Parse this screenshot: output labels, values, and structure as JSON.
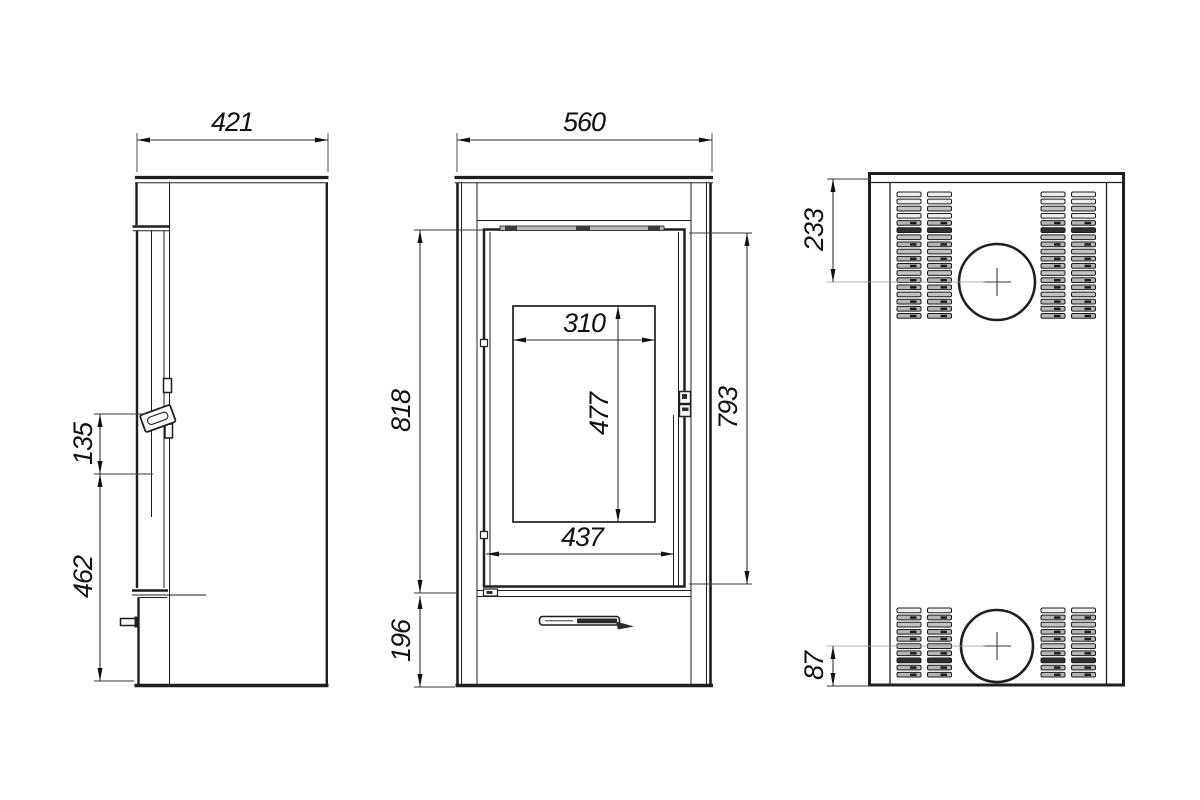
{
  "drawing": {
    "type": "technical-three-view-drawing",
    "subject": "freestanding stove",
    "background": "#ffffff",
    "line_color": "#1f1f1f",
    "dim_text_color": "#111111",
    "views": [
      {
        "id": "side-view",
        "label": "side view"
      },
      {
        "id": "front-view",
        "label": "front view"
      },
      {
        "id": "back-view",
        "label": "back view"
      }
    ]
  },
  "dimensions": {
    "side": {
      "depth": "421",
      "handle_span": "135",
      "handle_height": "462"
    },
    "front": {
      "width": "560",
      "door_height": "818",
      "base_height": "196",
      "glass_width": "310",
      "glass_height": "477",
      "door_width": "437",
      "door_height_right": "793"
    },
    "back": {
      "upper_flue_offset": "233",
      "lower_flue_offset": "87"
    }
  },
  "dim_annotations": [
    {
      "value": "421",
      "type": "h",
      "x1": 137,
      "x2": 328,
      "y": 140,
      "lx": 232,
      "ly": 131,
      "ext": [
        {
          "o": "v",
          "x": 137,
          "y1": 133,
          "y2": 172
        },
        {
          "o": "v",
          "x": 328,
          "y1": 133,
          "y2": 172
        }
      ]
    },
    {
      "value": "560",
      "type": "h",
      "x1": 457,
      "x2": 712,
      "y": 140,
      "lx": 584,
      "ly": 131,
      "ext": [
        {
          "o": "v",
          "x": 457,
          "y1": 133,
          "y2": 172
        },
        {
          "o": "v",
          "x": 712,
          "y1": 133,
          "y2": 172
        }
      ]
    },
    {
      "value": "135",
      "type": "v",
      "x": 100,
      "y1": 414,
      "y2": 474,
      "lx": 92,
      "ly": 444,
      "ext": [
        {
          "o": "h",
          "y": 414,
          "x1": 94,
          "x2": 146
        },
        {
          "o": "h",
          "y": 474,
          "x1": 94,
          "x2": 153
        }
      ]
    },
    {
      "value": "462",
      "type": "v",
      "x": 100,
      "y1": 474,
      "y2": 681,
      "lx": 92,
      "ly": 577,
      "ext": [
        {
          "o": "h",
          "y": 681,
          "x1": 94,
          "x2": 134
        }
      ]
    },
    {
      "value": "818",
      "type": "v",
      "x": 420,
      "y1": 230,
      "y2": 593,
      "lx": 410,
      "ly": 411,
      "ext": [
        {
          "o": "h",
          "y": 230,
          "x1": 414,
          "x2": 484
        },
        {
          "o": "h",
          "y": 593,
          "x1": 414,
          "x2": 456
        }
      ]
    },
    {
      "value": "196",
      "type": "v",
      "x": 420,
      "y1": 596,
      "y2": 687,
      "lx": 410,
      "ly": 641,
      "ext": [
        {
          "o": "h",
          "y": 687,
          "x1": 414,
          "x2": 455
        }
      ]
    },
    {
      "value": "310",
      "type": "h",
      "x1": 513,
      "x2": 655,
      "y": 340,
      "lx": 584,
      "ly": 332
    },
    {
      "value": "477",
      "type": "v",
      "x": 618,
      "y1": 306,
      "y2": 522,
      "lx": 608,
      "ly": 414
    },
    {
      "value": "437",
      "type": "h",
      "x1": 486,
      "x2": 674,
      "y": 554,
      "lx": 582,
      "ly": 546
    },
    {
      "value": "793",
      "type": "v",
      "x": 747,
      "y1": 233,
      "y2": 584,
      "lx": 737,
      "ly": 408,
      "ext": [
        {
          "o": "h",
          "y": 233,
          "x1": 689,
          "x2": 752
        },
        {
          "o": "h",
          "y": 584,
          "x1": 689,
          "x2": 752
        }
      ]
    },
    {
      "value": "233",
      "type": "v",
      "x": 833,
      "y1": 179,
      "y2": 282,
      "lx": 823,
      "ly": 230,
      "ext": [
        {
          "o": "h",
          "y": 179,
          "x1": 827,
          "x2": 870
        },
        {
          "o": "h",
          "y": 282,
          "x1": 827,
          "x2": 985,
          "thin": true
        }
      ]
    },
    {
      "value": "87",
      "type": "v",
      "x": 833,
      "y1": 646,
      "y2": 686,
      "lx": 823,
      "ly": 666,
      "ext": [
        {
          "o": "h",
          "y": 646,
          "x1": 827,
          "x2": 985,
          "thin": true
        },
        {
          "o": "h",
          "y": 686,
          "x1": 827,
          "x2": 870
        }
      ]
    }
  ],
  "back_view": {
    "vents": {
      "columns_x": [
        897,
        927.5,
        1041,
        1071.5
      ],
      "slot_w": 24,
      "slot_h": 4.7,
      "pitch": 7.15,
      "blocks": [
        {
          "y": 192,
          "rows": 18
        },
        {
          "y": 608,
          "rows": 10
        }
      ],
      "pattern_upper": [
        "w",
        "w",
        "l",
        "w",
        "t",
        "d",
        "l",
        "t",
        "l",
        "t",
        "t",
        "l",
        "t",
        "t",
        "l",
        "t",
        "t",
        "t"
      ],
      "pattern_lower": [
        "w",
        "t",
        "l",
        "t",
        "t",
        "l",
        "t",
        "d",
        "t",
        "t"
      ]
    },
    "flues": [
      {
        "cx": 997,
        "cy": 282,
        "r": 38
      },
      {
        "cx": 997,
        "cy": 646,
        "r": 36
      }
    ]
  }
}
